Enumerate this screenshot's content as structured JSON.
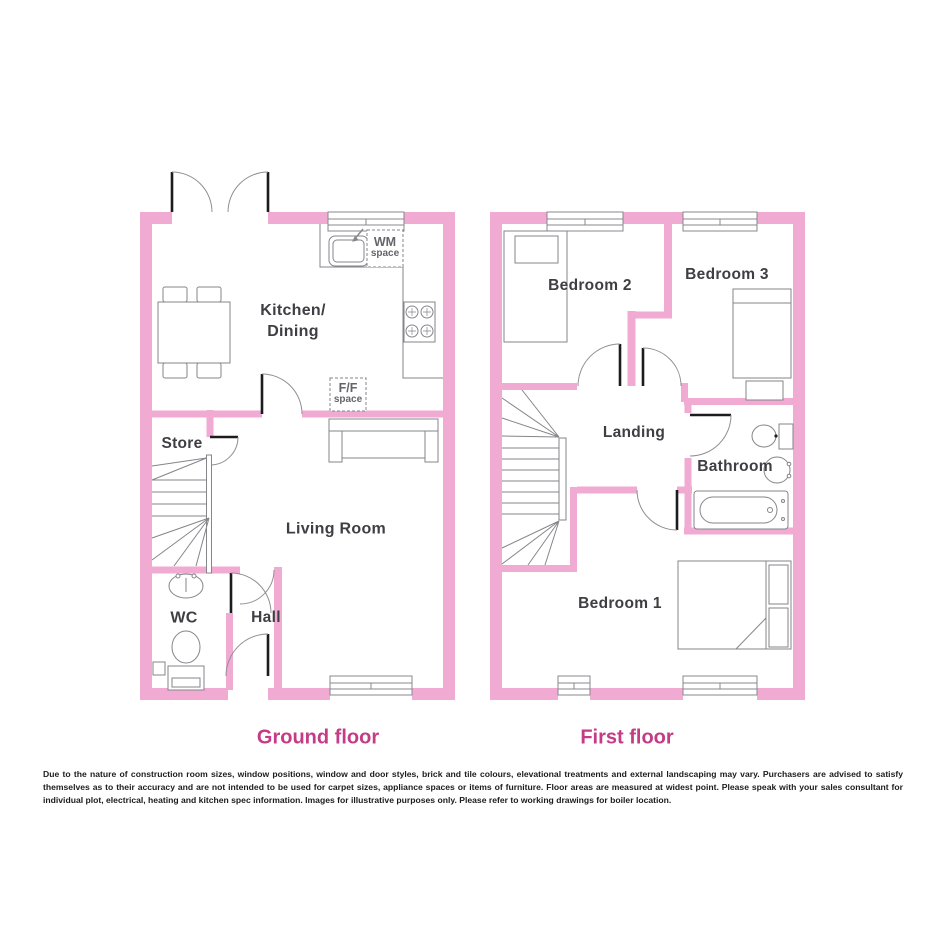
{
  "ground": {
    "title": "Ground floor",
    "kitchen_line1": "Kitchen/",
    "kitchen_line2": "Dining",
    "store": "Store",
    "living": "Living Room",
    "wc": "WC",
    "hall": "Hall",
    "wm_line1": "WM",
    "wm_line2": "space",
    "ff_line1": "F/F",
    "ff_line2": "space"
  },
  "first": {
    "title": "First floor",
    "bedroom2": "Bedroom 2",
    "bedroom3": "Bedroom 3",
    "landing": "Landing",
    "bathroom": "Bathroom",
    "bedroom1": "Bedroom 1"
  },
  "disclaimer": "Due to the nature of construction room sizes, window positions, window and door styles, brick and tile colours, elevational treatments and external landscaping may vary. Purchasers are advised to satisfy themselves as to their accuracy and are not intended to be used for carpet sizes, appliance spaces or items of furniture. Floor areas are measured at widest point. Please speak with your sales consultant for individual plot, electrical, heating and kitchen spec information. Images for illustrative purposes only. Please refer to working drawings for boiler location.",
  "colors": {
    "wall_pink": "#F1AAD2",
    "accent_pink": "#C43C85",
    "label_grey": "#3E3E43"
  }
}
